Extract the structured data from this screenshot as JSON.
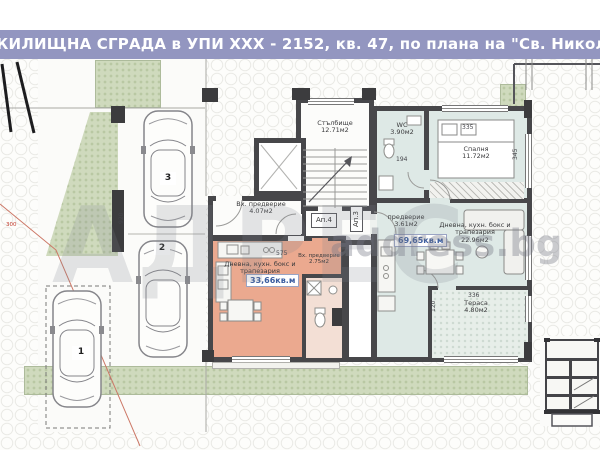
{
  "title": "ЖИЛИЩНА СГРАДА в УПИ XXX - 2152, кв. 47, по плана на \"Св. Никола\", гр. В",
  "watermark": {
    "logo": "АДРЕС",
    "site": "address.bg"
  },
  "common_areas": {
    "staircase_name": "Стълбище",
    "staircase_area": "12.71м2"
  },
  "apt4": {
    "badge": "Ап.4",
    "entry_name": "Вх. предверие",
    "entry_area": "4.07м2",
    "living_name": "Дневна, кухн. бокс и трапезария",
    "living_area": "19.10м2",
    "entry2_name": "Вх. предверие",
    "entry2_area": "2.75м2",
    "total": "33,66кв.м"
  },
  "apt3": {
    "badge": "Ап.3",
    "vestibule_name": "предверие",
    "vestibule_area": "3.61м2",
    "living_name": "Дневна, кухн. бокс и трапезария",
    "living_area": "22.96м2",
    "bedroom_name": "Спалня",
    "bedroom_area": "11.72м2",
    "wc_name": "WC",
    "wc_area": "3.90м2",
    "terrace_name": "Тераса",
    "terrace_area": "4.80м2",
    "total": "69,65кв.м"
  },
  "parking": {
    "spot1": "1",
    "spot2": "2",
    "spot3": "3"
  },
  "dims": {
    "d920": "920",
    "d575": "575",
    "d335": "335",
    "d345": "345",
    "d194": "194",
    "d336": "336",
    "d300": "300",
    "d120": "120"
  },
  "colors": {
    "titlebar": "#9396c0",
    "wall": "#47474a",
    "apt4_fill": "#eba98f",
    "apt3_fill": "#dee9e6",
    "green": "#cfdabd",
    "total_text": "#3a5da0"
  }
}
